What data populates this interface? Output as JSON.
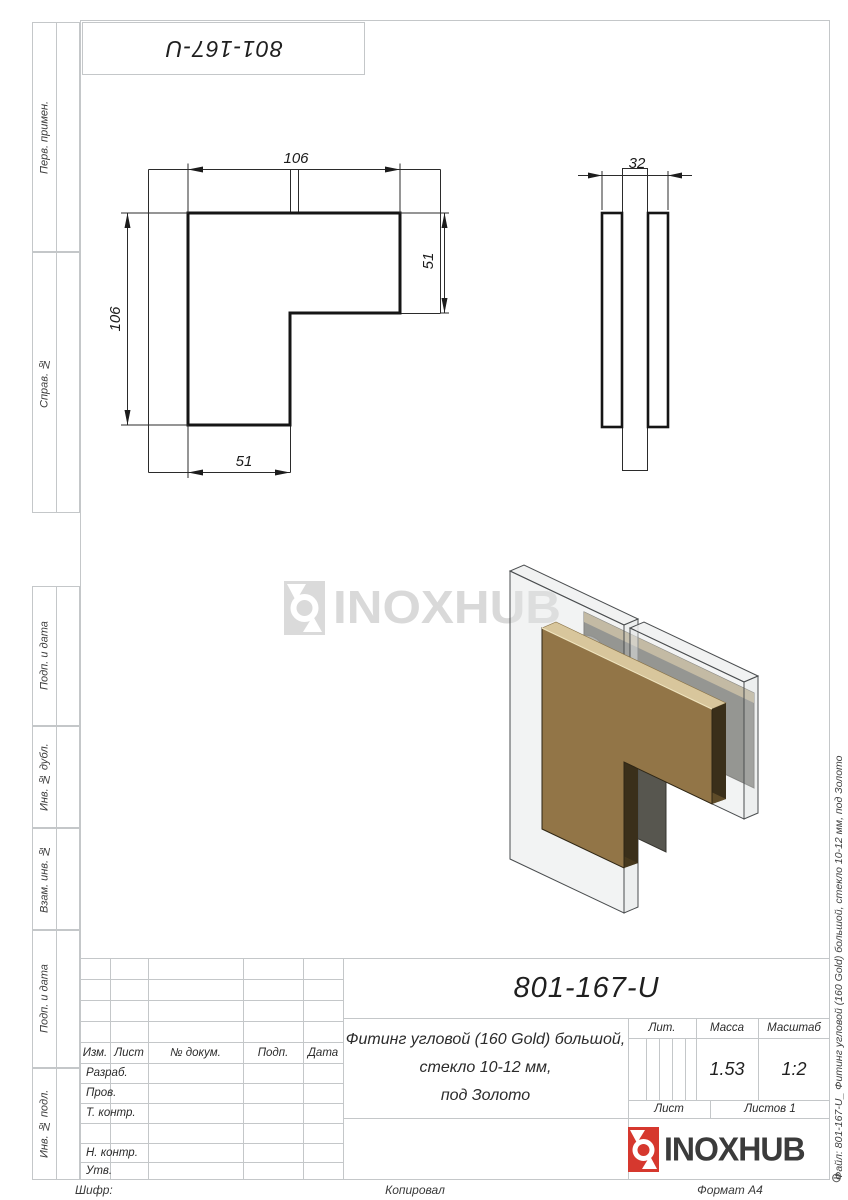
{
  "stamp": {
    "code": "801-167-U"
  },
  "margin": {
    "labels": [
      "Перв. примен.",
      "Справ. №",
      "Подп. и дата",
      "Инв. № дубл.",
      "Взам. инв. №",
      "Подп. и дата",
      "Инв. № подл."
    ]
  },
  "views": {
    "front": {
      "dim_top": "106",
      "dim_left": "106",
      "dim_right": "51",
      "dim_bottom": "51"
    },
    "side": {
      "dim_width": "32"
    }
  },
  "watermark": {
    "brand": "INOXHUB"
  },
  "title_block": {
    "designation": "801-167-U",
    "description_line1": "Фитинг угловой (160 Gold) большой,",
    "description_line2": "стекло 10-12 мм,",
    "description_line3": "под Золото",
    "columns": {
      "izm": "Изм.",
      "list": "Лист",
      "doc": "№ докум.",
      "podp": "Подп.",
      "data": "Дата"
    },
    "rows": {
      "razrab": "Разраб.",
      "prov": "Пров.",
      "tkontr": "Т. контр.",
      "nkontr": "Н. контр.",
      "utv": "Утв."
    },
    "lit_label": "Лит.",
    "mass_label": "Масса",
    "scale_label": "Масштаб",
    "mass_value": "1.53",
    "scale_value": "1:2",
    "sheet_label": "Лист",
    "sheets_label": "Листов 1",
    "brand": "INOXHUB"
  },
  "footer": {
    "cipher": "Шифр:",
    "copied": "Копировал",
    "format": "Формат А4",
    "corner_mark": "⊖"
  },
  "side_note": {
    "file": "Файл: 801-167-U_ Фитинг угловой (160 Gold) большой, стекло 10-12 мм, под Золото"
  },
  "colors": {
    "accent_red": "#d6382e",
    "gold_face": "#927547",
    "gold_bevel": "#d8c69c",
    "backplate_gray": "#57564f",
    "watermark_gray": "#d9d9d9",
    "frame_gray": "#c4c7c9",
    "ink": "#1c1c1c"
  }
}
